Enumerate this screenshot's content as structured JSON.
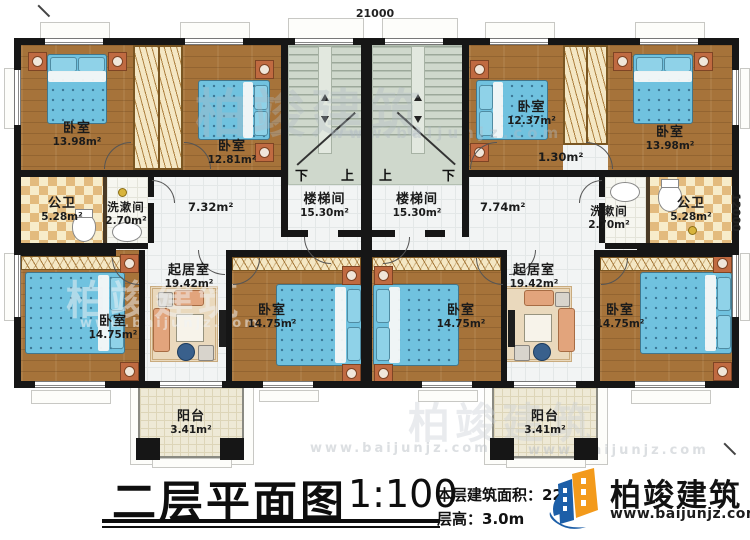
{
  "drawing": {
    "title": "二层平面图",
    "scale": "1:100",
    "floor_area_label": "本层建筑面积：",
    "floor_area_value": "223",
    "floor_height_label": "层高：",
    "floor_height_value": "3.0m"
  },
  "logo": {
    "company": "柏竣建筑",
    "website": "www.baijunjz.com"
  },
  "dimensions": {
    "top": "21000",
    "right": "12000"
  },
  "watermark": {
    "brand": "柏竣建筑",
    "site": "www.baijunjz.com"
  },
  "stair_labels": {
    "left_down": "下",
    "left_up": "上",
    "right_up": "上",
    "right_down": "下"
  },
  "rooms": {
    "bedroom_tl1": {
      "label": "卧室",
      "area": "13.98m²"
    },
    "bedroom_tl2": {
      "label": "卧室",
      "area": "12.81m²"
    },
    "bath_left": {
      "label": "公卫",
      "area": "5.28m²"
    },
    "wash_left": {
      "label": "洗漱间",
      "area": "2.70m²"
    },
    "hall_left": {
      "area": "7.32m²"
    },
    "stair_left": {
      "label": "楼梯间",
      "area": "15.30m²"
    },
    "living_left": {
      "label": "起居室",
      "area": "19.42m²"
    },
    "bedroom_bl1": {
      "label": "卧室",
      "area": "14.75m²"
    },
    "bedroom_bl2": {
      "label": "卧室",
      "area": "14.75m²"
    },
    "balcony_left": {
      "label": "阳台",
      "area": "3.41m²"
    },
    "bedroom_tr1": {
      "label": "卧室",
      "area": "12.37m²"
    },
    "bedroom_tr2": {
      "label": "卧室",
      "area": "13.98m²"
    },
    "closet_right": {
      "area": "1.30m²"
    },
    "stair_right": {
      "label": "楼梯间",
      "area": "15.30m²"
    },
    "hall_right": {
      "area": "7.74m²"
    },
    "wash_right": {
      "label": "洗漱间",
      "area": "2.70m²"
    },
    "bath_right": {
      "label": "公卫",
      "area": "5.28m²"
    },
    "living_right": {
      "label": "起居室",
      "area": "19.42m²"
    },
    "bedroom_br1": {
      "label": "卧室",
      "area": "14.75m²"
    },
    "bedroom_br2": {
      "label": "卧室",
      "area": "14.75m²"
    },
    "balcony_right": {
      "label": "阳台",
      "area": "3.41m²"
    }
  }
}
